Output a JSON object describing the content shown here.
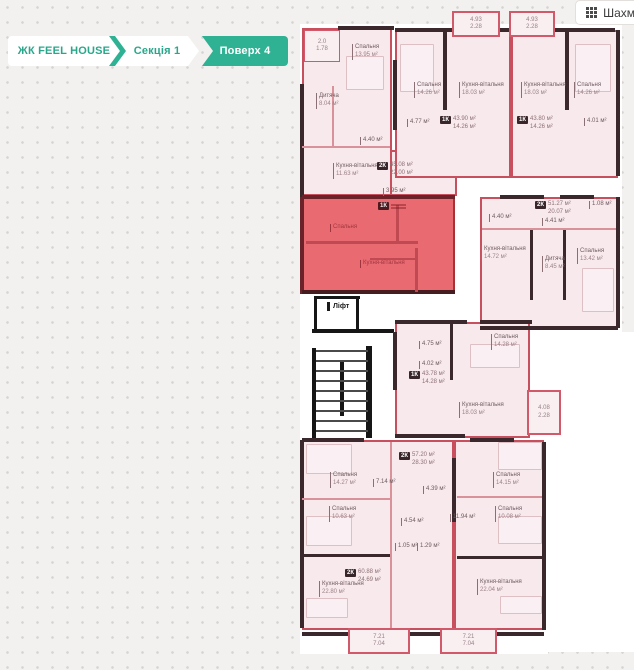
{
  "breadcrumb": {
    "accent": "#2fb293",
    "items": [
      {
        "label": "ЖК FEEL HOUSE",
        "active": false
      },
      {
        "label": "Секція 1",
        "active": false
      },
      {
        "label": "Поверх 4",
        "active": true
      }
    ]
  },
  "toolbar": {
    "chess_button_label": "Шахм",
    "chess_icon": "grid-3x3-icon"
  },
  "plan": {
    "colors": {
      "unit_fill": "#f8e9ec",
      "unit_border": "#c8505e",
      "selected_fill": "#e96a70",
      "wall": "#3a282c"
    },
    "lift_label": "Ліфт",
    "underlays": [
      {
        "x": 300,
        "y": 24,
        "w": 322,
        "h": 416
      },
      {
        "x": 300,
        "y": 440,
        "w": 248,
        "h": 214
      },
      {
        "x": 548,
        "y": 332,
        "w": 86,
        "h": 320
      }
    ],
    "units": [
      {
        "id": "top-left",
        "x": 302,
        "y": 28,
        "w": 90,
        "h": 168
      },
      {
        "id": "top-left-ext",
        "x": 390,
        "y": 150,
        "w": 67,
        "h": 46
      },
      {
        "id": "top-mid-1k",
        "x": 395,
        "y": 30,
        "w": 116,
        "h": 148
      },
      {
        "id": "top-right-1k",
        "x": 511,
        "y": 30,
        "w": 107,
        "h": 148
      },
      {
        "id": "mid-right-2k",
        "x": 480,
        "y": 197,
        "w": 138,
        "h": 132
      },
      {
        "id": "selected-1k",
        "x": 302,
        "y": 197,
        "w": 153,
        "h": 97,
        "selected": true
      },
      {
        "id": "mid-1k",
        "x": 395,
        "y": 322,
        "w": 135,
        "h": 116
      },
      {
        "id": "bottom-left-2k",
        "x": 302,
        "y": 440,
        "w": 152,
        "h": 190
      },
      {
        "id": "bottom-right-2k",
        "x": 454,
        "y": 440,
        "w": 90,
        "h": 190
      }
    ],
    "balconies": [
      {
        "x": 452,
        "y": 11,
        "w": 48,
        "h": 26,
        "l1": "4.93",
        "l2": "2.28"
      },
      {
        "x": 509,
        "y": 11,
        "w": 46,
        "h": 26,
        "l1": "4.93",
        "l2": "2.28"
      },
      {
        "x": 527,
        "y": 390,
        "w": 34,
        "h": 45,
        "l1": "4.08",
        "l2": "2.28"
      },
      {
        "x": 348,
        "y": 628,
        "w": 62,
        "h": 26,
        "l1": "7.21",
        "l2": "7.04"
      },
      {
        "x": 440,
        "y": 628,
        "w": 57,
        "h": 26,
        "l1": "7.21",
        "l2": "7.04"
      },
      {
        "x": 304,
        "y": 30,
        "w": 36,
        "h": 32,
        "l1": "2.0",
        "l2": "1.78",
        "thin": true
      }
    ],
    "badges": [
      {
        "t": "2К",
        "a1": "45.08 м²",
        "a2": "22.00 м²",
        "x": 377,
        "y": 162
      },
      {
        "t": "1К",
        "a1": "43.90 м²",
        "a2": "14.26 м²",
        "x": 440,
        "y": 116
      },
      {
        "t": "1К",
        "a1": "43.80 м²",
        "a2": "14.26 м²",
        "x": 517,
        "y": 116
      },
      {
        "t": "2К",
        "a1": "51.27 м²",
        "a2": "20.07 м²",
        "x": 535,
        "y": 201
      },
      {
        "t": "1К",
        "a1": "",
        "a2": "",
        "x": 378,
        "y": 202,
        "sel": true
      },
      {
        "t": "1К",
        "a1": "43.78 м²",
        "a2": "14.28 м²",
        "x": 409,
        "y": 371
      },
      {
        "t": "2К",
        "a1": "57.20 м²",
        "a2": "28.30 м²",
        "x": 399,
        "y": 452
      },
      {
        "t": "2К",
        "a1": "60.88 м²",
        "a2": "24.69 м²",
        "x": 345,
        "y": 569
      }
    ],
    "labels": [
      {
        "n": "Спальня",
        "a": "13.95 м²",
        "x": 352,
        "y": 44
      },
      {
        "n": "Дитяча",
        "a": "8.04 м²",
        "x": 316,
        "y": 93
      },
      {
        "n": "Кухня-вітальня",
        "a": "11.63 м²",
        "x": 333,
        "y": 163
      },
      {
        "n": "4.40 м²",
        "x": 360,
        "y": 137
      },
      {
        "n": "3.95 м²",
        "x": 383,
        "y": 188
      },
      {
        "n": "Спальня",
        "a": "14.26 м²",
        "x": 414,
        "y": 82
      },
      {
        "n": "Кухня-вітальня",
        "a": "18.03 м²",
        "x": 459,
        "y": 82
      },
      {
        "n": "4.77 м²",
        "x": 407,
        "y": 119
      },
      {
        "n": "Кухня-вітальня",
        "a": "18.03 м²",
        "x": 521,
        "y": 82
      },
      {
        "n": "Спальня",
        "a": "14.26 м²",
        "x": 574,
        "y": 82
      },
      {
        "n": "4.01 м²",
        "x": 584,
        "y": 118
      },
      {
        "n": "1.08 м²",
        "x": 589,
        "y": 201
      },
      {
        "n": "4.40 м²",
        "x": 489,
        "y": 214
      },
      {
        "n": "4.41 м²",
        "x": 542,
        "y": 218
      },
      {
        "n": "Кухня-вітальня",
        "a": "14.72 м²",
        "x": 481,
        "y": 246
      },
      {
        "n": "Дитяча",
        "a": "8.45 м²",
        "x": 542,
        "y": 256
      },
      {
        "n": "Спальня",
        "a": "13.42 м²",
        "x": 577,
        "y": 248
      },
      {
        "n": "Спальня",
        "x": 330,
        "y": 224,
        "v": "sel"
      },
      {
        "n": "Кухня-вітальня",
        "x": 360,
        "y": 260,
        "v": "sel"
      },
      {
        "n": "Ліфт",
        "x": 327,
        "y": 302,
        "v": "lift"
      },
      {
        "n": "4.75 м²",
        "x": 419,
        "y": 341
      },
      {
        "n": "4.02 м²",
        "x": 419,
        "y": 361
      },
      {
        "n": "Спальня",
        "a": "14.28 м²",
        "x": 491,
        "y": 334
      },
      {
        "n": "Кухня-вітальня",
        "a": "18.03 м²",
        "x": 459,
        "y": 402
      },
      {
        "n": "Спальня",
        "a": "14.27 м²",
        "x": 330,
        "y": 472
      },
      {
        "n": "7.14 м²",
        "x": 373,
        "y": 479
      },
      {
        "n": "4.39 м²",
        "x": 423,
        "y": 486
      },
      {
        "n": "Спальня",
        "a": "10.63 м²",
        "x": 329,
        "y": 506
      },
      {
        "n": "4.54 м²",
        "x": 401,
        "y": 518
      },
      {
        "n": "11.94 м²",
        "x": 450,
        "y": 514
      },
      {
        "n": "1.05 м²",
        "x": 395,
        "y": 543
      },
      {
        "n": "1.29 м²",
        "x": 417,
        "y": 543
      },
      {
        "n": "Кухня-вітальня",
        "a": "22.80 м²",
        "x": 319,
        "y": 581
      },
      {
        "n": "Спальня",
        "a": "14.15 м²",
        "x": 493,
        "y": 472
      },
      {
        "n": "Спальня",
        "a": "10.08 м²",
        "x": 495,
        "y": 506
      },
      {
        "n": "Кухня-вітальня",
        "a": "22.04 м²",
        "x": 477,
        "y": 579
      }
    ],
    "walls": [
      {
        "x": 338,
        "y": 26,
        "w": 56,
        "h": 4
      },
      {
        "x": 300,
        "y": 84,
        "w": 4,
        "h": 114
      },
      {
        "x": 395,
        "y": 28,
        "w": 58,
        "h": 4
      },
      {
        "x": 500,
        "y": 28,
        "w": 10,
        "h": 4
      },
      {
        "x": 553,
        "y": 28,
        "w": 62,
        "h": 4
      },
      {
        "x": 616,
        "y": 30,
        "w": 4,
        "h": 146
      },
      {
        "x": 443,
        "y": 32,
        "w": 4,
        "h": 78
      },
      {
        "x": 565,
        "y": 32,
        "w": 4,
        "h": 78
      },
      {
        "x": 393,
        "y": 60,
        "w": 4,
        "h": 70
      },
      {
        "x": 616,
        "y": 197,
        "w": 4,
        "h": 131
      },
      {
        "x": 480,
        "y": 326,
        "w": 138,
        "h": 4
      },
      {
        "x": 500,
        "y": 195,
        "w": 44,
        "h": 4
      },
      {
        "x": 560,
        "y": 195,
        "w": 34,
        "h": 4
      },
      {
        "x": 530,
        "y": 230,
        "w": 3,
        "h": 70
      },
      {
        "x": 563,
        "y": 230,
        "w": 3,
        "h": 70
      },
      {
        "x": 482,
        "y": 228,
        "w": 134,
        "h": 2,
        "c": "#d9929a"
      },
      {
        "x": 302,
        "y": 195,
        "w": 153,
        "h": 4,
        "c": "#6b2228"
      },
      {
        "x": 300,
        "y": 197,
        "w": 4,
        "h": 97,
        "c": "#6b2228"
      },
      {
        "x": 302,
        "y": 290,
        "w": 153,
        "h": 4,
        "c": "#471c20"
      },
      {
        "x": 306,
        "y": 241,
        "w": 112,
        "h": 3,
        "c": "#c14a52"
      },
      {
        "x": 396,
        "y": 205,
        "w": 3,
        "h": 38,
        "c": "#c14a52"
      },
      {
        "x": 370,
        "y": 258,
        "w": 48,
        "h": 2,
        "c": "#c14a52"
      },
      {
        "x": 415,
        "y": 248,
        "w": 3,
        "h": 44,
        "c": "#c14a52"
      },
      {
        "x": 314,
        "y": 296,
        "w": 46,
        "h": 3,
        "c": "#161616"
      },
      {
        "x": 314,
        "y": 296,
        "w": 3,
        "h": 33,
        "c": "#161616"
      },
      {
        "x": 356,
        "y": 296,
        "w": 3,
        "h": 33,
        "c": "#161616"
      },
      {
        "x": 312,
        "y": 329,
        "w": 82,
        "h": 4,
        "c": "#161616"
      },
      {
        "x": 312,
        "y": 348,
        "w": 4,
        "h": 92,
        "c": "#161616"
      },
      {
        "x": 366,
        "y": 346,
        "w": 6,
        "h": 92,
        "c": "#161616"
      },
      {
        "x": 340,
        "y": 360,
        "w": 4,
        "h": 56,
        "c": "#161616"
      },
      {
        "x": 395,
        "y": 320,
        "w": 72,
        "h": 4
      },
      {
        "x": 480,
        "y": 320,
        "w": 52,
        "h": 4
      },
      {
        "x": 450,
        "y": 324,
        "w": 3,
        "h": 56
      },
      {
        "x": 393,
        "y": 332,
        "w": 4,
        "h": 58
      },
      {
        "x": 395,
        "y": 434,
        "w": 70,
        "h": 4
      },
      {
        "x": 302,
        "y": 438,
        "w": 62,
        "h": 4
      },
      {
        "x": 470,
        "y": 438,
        "w": 44,
        "h": 4
      },
      {
        "x": 300,
        "y": 440,
        "w": 4,
        "h": 188
      },
      {
        "x": 542,
        "y": 442,
        "w": 4,
        "h": 188
      },
      {
        "x": 452,
        "y": 458,
        "w": 4,
        "h": 64
      },
      {
        "x": 302,
        "y": 632,
        "w": 48,
        "h": 4
      },
      {
        "x": 410,
        "y": 632,
        "w": 32,
        "h": 4
      },
      {
        "x": 497,
        "y": 632,
        "w": 47,
        "h": 4
      },
      {
        "x": 302,
        "y": 498,
        "w": 88,
        "h": 2,
        "c": "#d9929a"
      },
      {
        "x": 302,
        "y": 554,
        "w": 90,
        "h": 3
      },
      {
        "x": 457,
        "y": 496,
        "w": 85,
        "h": 2,
        "c": "#d9929a"
      },
      {
        "x": 457,
        "y": 556,
        "w": 85,
        "h": 3
      },
      {
        "x": 390,
        "y": 442,
        "w": 2,
        "h": 186,
        "c": "#d9929a"
      },
      {
        "x": 332,
        "y": 86,
        "w": 2,
        "h": 60,
        "c": "#d9929a"
      },
      {
        "x": 302,
        "y": 146,
        "w": 88,
        "h": 2,
        "c": "#d9929a"
      }
    ],
    "stairs": {
      "x": 316,
      "y": 350,
      "w": 52,
      "h": 88
    },
    "furniture": [
      {
        "x": 346,
        "y": 56,
        "w": 36,
        "h": 32
      },
      {
        "x": 400,
        "y": 44,
        "w": 32,
        "h": 46
      },
      {
        "x": 575,
        "y": 44,
        "w": 34,
        "h": 46
      },
      {
        "x": 582,
        "y": 268,
        "w": 30,
        "h": 42
      },
      {
        "x": 470,
        "y": 344,
        "w": 48,
        "h": 22
      },
      {
        "x": 306,
        "y": 444,
        "w": 44,
        "h": 28
      },
      {
        "x": 306,
        "y": 516,
        "w": 44,
        "h": 28
      },
      {
        "x": 498,
        "y": 442,
        "w": 42,
        "h": 26
      },
      {
        "x": 498,
        "y": 516,
        "w": 42,
        "h": 26
      },
      {
        "x": 306,
        "y": 598,
        "w": 40,
        "h": 18
      },
      {
        "x": 500,
        "y": 596,
        "w": 40,
        "h": 16
      }
    ]
  }
}
